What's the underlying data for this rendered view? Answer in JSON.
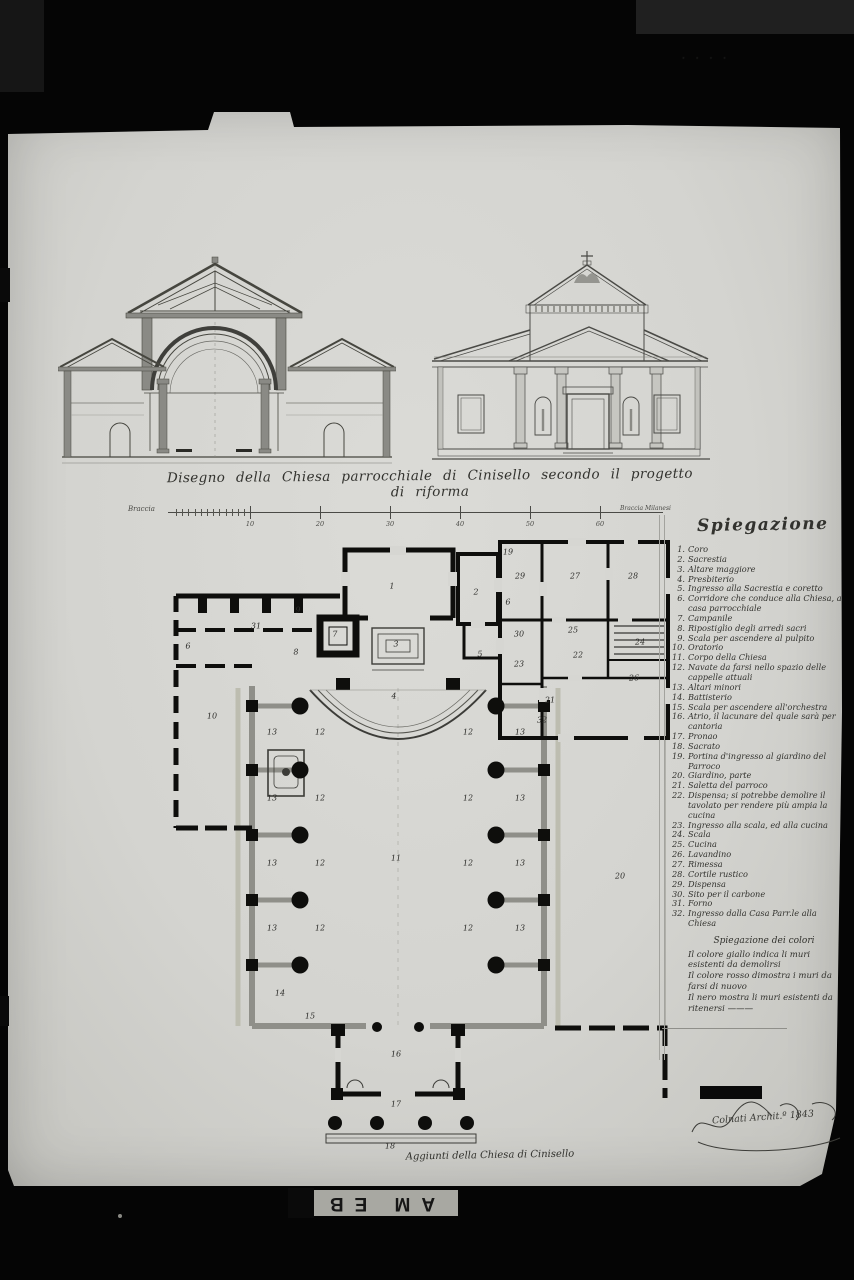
{
  "title": "Disegno della Chiesa parrocchiale di Cinisello secondo il progetto di riforma",
  "scale_bar": {
    "left_label": "Braccia",
    "right_label": "Braccia Milanesi",
    "tick_labels": [
      "10",
      "20",
      "30",
      "40",
      "50",
      "60"
    ]
  },
  "legend": {
    "heading": "Spiegazione",
    "items": [
      {
        "num": "1.",
        "text": "Coro"
      },
      {
        "num": "2.",
        "text": "Sacrestia"
      },
      {
        "num": "3.",
        "text": "Altare maggiore"
      },
      {
        "num": "4.",
        "text": "Presbiterio"
      },
      {
        "num": "5.",
        "text": "Ingresso alla Sacrestia e coretto"
      },
      {
        "num": "6.",
        "text": "Corridore che conduce alla Chiesa, a casa parrocchiale"
      },
      {
        "num": "7.",
        "text": "Campanile"
      },
      {
        "num": "8.",
        "text": "Ripostiglio degli arredi sacri"
      },
      {
        "num": "9.",
        "text": "Scala per ascendere al pulpito"
      },
      {
        "num": "10.",
        "text": "Oratorio"
      },
      {
        "num": "11.",
        "text": "Corpo della Chiesa"
      },
      {
        "num": "12.",
        "text": "Navate da farsi nello spazio delle cappelle attuali"
      },
      {
        "num": "13.",
        "text": "Altari minori"
      },
      {
        "num": "14.",
        "text": "Battisterio"
      },
      {
        "num": "15.",
        "text": "Scala per ascendere all'orchestra"
      },
      {
        "num": "16.",
        "text": "Atrio, il lacunare del quale sarà per cantoria"
      },
      {
        "num": "17.",
        "text": "Pronao"
      },
      {
        "num": "18.",
        "text": "Sacrato"
      },
      {
        "num": "19.",
        "text": "Portina d'ingresso al giardino del Parroco"
      },
      {
        "num": "20.",
        "text": "Giardino, parte"
      },
      {
        "num": "21.",
        "text": "Saletta del parroco"
      },
      {
        "num": "22.",
        "text": "Dispensa; si potrebbe demolire il tavolato per rendere più ampia la cucina"
      },
      {
        "num": "23.",
        "text": "Ingresso alla scala, ed alla cucina"
      },
      {
        "num": "24.",
        "text": "Scala"
      },
      {
        "num": "25.",
        "text": "Cucina"
      },
      {
        "num": "26.",
        "text": "Lavandino"
      },
      {
        "num": "27.",
        "text": "Rimessa"
      },
      {
        "num": "28.",
        "text": "Cortile rustico"
      },
      {
        "num": "29.",
        "text": "Dispensa"
      },
      {
        "num": "30.",
        "text": "Sito per il carbone"
      },
      {
        "num": "31.",
        "text": "Forno"
      },
      {
        "num": "32.",
        "text": "Ingresso dalla Casa Parr.le alla Chiesa"
      }
    ]
  },
  "color_legend": {
    "heading": "Spiegazione dei colori",
    "entries": [
      "Il colore giallo indica li muri esistenti da demolirsi",
      "Il colore rosso dimostra i muri da farsi di nuovo",
      "Il nero mostra li muri esistenti da ritenersi ———"
    ]
  },
  "plan_labels": [
    {
      "t": "1",
      "x": 224,
      "y": 48
    },
    {
      "t": "2",
      "x": 308,
      "y": 54
    },
    {
      "t": "3",
      "x": 228,
      "y": 106
    },
    {
      "t": "4",
      "x": 226,
      "y": 158
    },
    {
      "t": "5",
      "x": 312,
      "y": 116
    },
    {
      "t": "6",
      "x": 20,
      "y": 108
    },
    {
      "t": "6",
      "x": 340,
      "y": 64
    },
    {
      "t": "7",
      "x": 167,
      "y": 96
    },
    {
      "t": "8",
      "x": 128,
      "y": 114
    },
    {
      "t": "9",
      "x": 130,
      "y": 72
    },
    {
      "t": "10",
      "x": 44,
      "y": 178
    },
    {
      "t": "11",
      "x": 228,
      "y": 320
    },
    {
      "t": "12",
      "x": 152,
      "y": 194
    },
    {
      "t": "13",
      "x": 104,
      "y": 194
    },
    {
      "t": "12",
      "x": 152,
      "y": 260
    },
    {
      "t": "13",
      "x": 104,
      "y": 260
    },
    {
      "t": "12",
      "x": 152,
      "y": 325
    },
    {
      "t": "13",
      "x": 104,
      "y": 325
    },
    {
      "t": "12",
      "x": 152,
      "y": 390
    },
    {
      "t": "13",
      "x": 104,
      "y": 390
    },
    {
      "t": "12",
      "x": 300,
      "y": 194
    },
    {
      "t": "13",
      "x": 352,
      "y": 194
    },
    {
      "t": "12",
      "x": 300,
      "y": 260
    },
    {
      "t": "13",
      "x": 352,
      "y": 260
    },
    {
      "t": "12",
      "x": 300,
      "y": 325
    },
    {
      "t": "13",
      "x": 352,
      "y": 325
    },
    {
      "t": "12",
      "x": 300,
      "y": 390
    },
    {
      "t": "13",
      "x": 352,
      "y": 390
    },
    {
      "t": "14",
      "x": 112,
      "y": 455
    },
    {
      "t": "15",
      "x": 142,
      "y": 478
    },
    {
      "t": "16",
      "x": 228,
      "y": 516
    },
    {
      "t": "17",
      "x": 228,
      "y": 566
    },
    {
      "t": "18",
      "x": 222,
      "y": 608
    },
    {
      "t": "19",
      "x": 340,
      "y": 14
    },
    {
      "t": "20",
      "x": 452,
      "y": 338
    },
    {
      "t": "21",
      "x": 382,
      "y": 162
    },
    {
      "t": "22",
      "x": 410,
      "y": 117
    },
    {
      "t": "23",
      "x": 351,
      "y": 126
    },
    {
      "t": "24",
      "x": 472,
      "y": 104
    },
    {
      "t": "25",
      "x": 405,
      "y": 92
    },
    {
      "t": "26",
      "x": 466,
      "y": 140
    },
    {
      "t": "27",
      "x": 407,
      "y": 38
    },
    {
      "t": "28",
      "x": 465,
      "y": 38
    },
    {
      "t": "29",
      "x": 352,
      "y": 38
    },
    {
      "t": "30",
      "x": 351,
      "y": 96
    },
    {
      "t": "31",
      "x": 88,
      "y": 88
    },
    {
      "t": "32",
      "x": 374,
      "y": 182
    }
  ],
  "signature": "Colnati Archit.º 1843",
  "bottom_caption": "Aggiunti della Chiesa di Cinisello",
  "archive_label": "AM EB",
  "corner_marks": "· · · ·",
  "colors": {
    "paper": "#d6d6d2",
    "ink": "#32322e",
    "wall_black": "#0e0e0c",
    "wall_new": "#8f8f89",
    "wall_old": "#bdbdb0"
  }
}
